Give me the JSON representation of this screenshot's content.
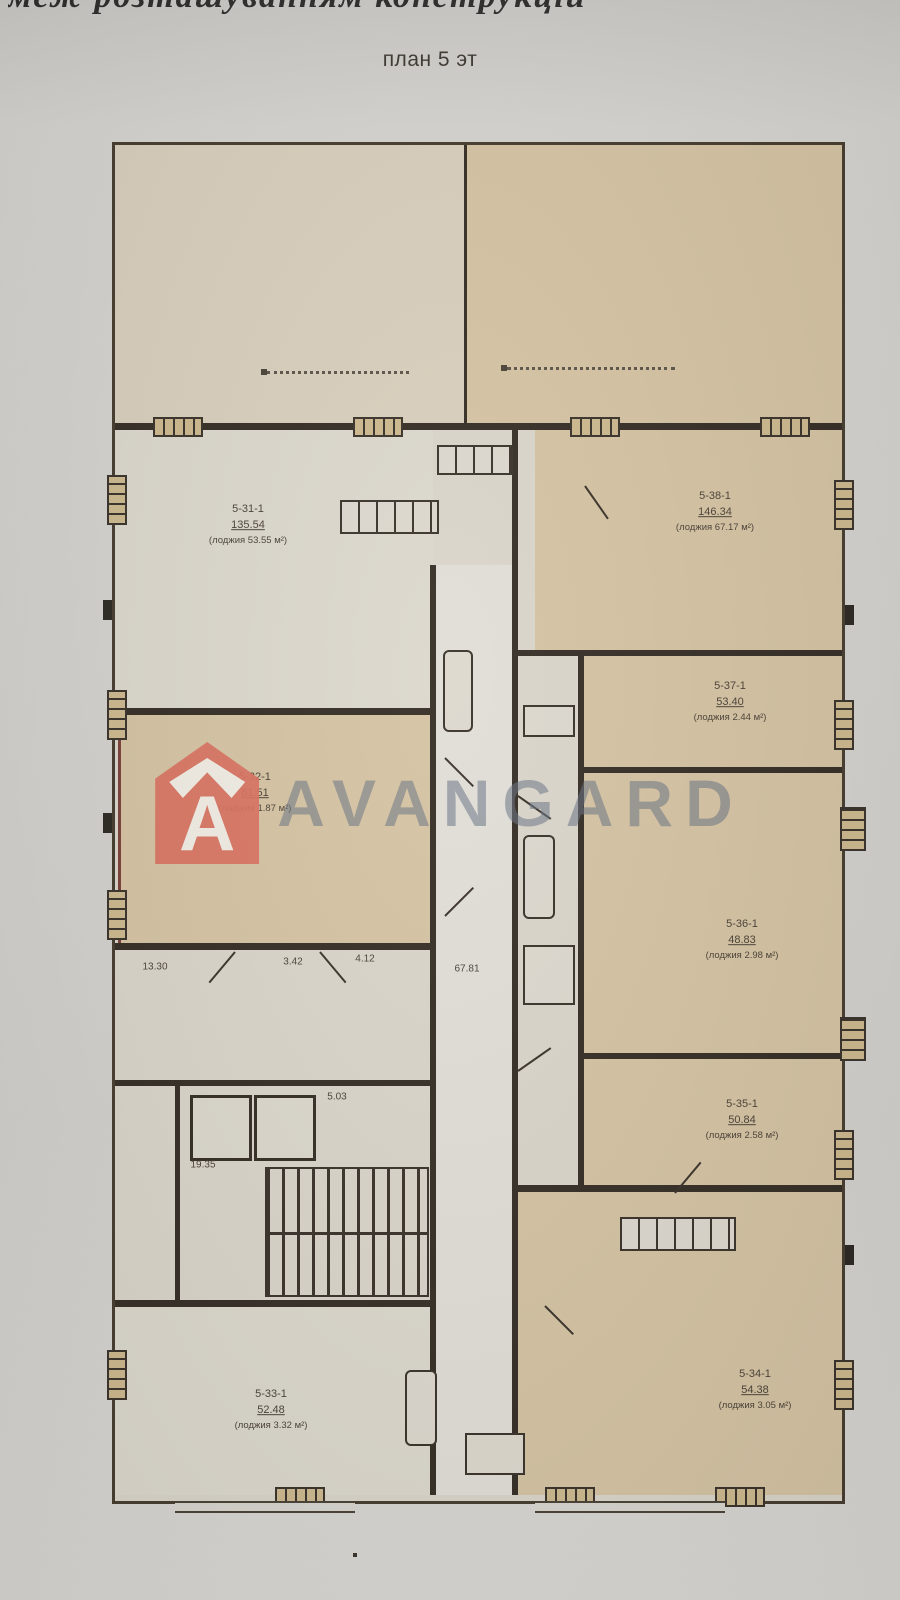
{
  "photo": {
    "clipped_top_text": "меж розташуванням конструкцій",
    "title": "план 5 эт"
  },
  "watermark": {
    "brand": "AVANGARD",
    "logo_letter": "A",
    "logo_color": "#da7160",
    "text_color": "#677383"
  },
  "plan": {
    "rooms": [
      {
        "id": "5-31-1",
        "area": "135.54",
        "note": "(лоджия 53.55 м²)"
      },
      {
        "id": "5-32-1",
        "area": "61.51",
        "note": "(лоджия 1.87 м²)"
      },
      {
        "id": "5-38-1",
        "area": "146.34",
        "note": "(лоджия 67.17 м²)"
      },
      {
        "id": "5-37-1",
        "area": "53.40",
        "note": "(лоджия 2.44 м²)"
      },
      {
        "id": "5-36-1",
        "area": "48.83",
        "note": "(лоджия 2.98 м²)"
      },
      {
        "id": "5-35-1",
        "area": "50.84",
        "note": "(лоджия 2.58 м²)"
      },
      {
        "id": "5-34-1",
        "area": "54.38",
        "note": "(лоджия 3.05 м²)"
      },
      {
        "id": "5-33-1",
        "area": "52.48",
        "note": "(лоджия 3.32 м²)"
      }
    ],
    "corridor_area": "67.81",
    "stair_area": "19.35",
    "lobby_area": "5.03",
    "hall_areas": [
      "13.30",
      "3.42",
      "4.12"
    ],
    "colors": {
      "wall": "#352e26",
      "room_tan": "#d5c3a3",
      "room_light": "#dcd8cd",
      "red_outline": "#7c4138",
      "paper": "#d3d1cd"
    }
  }
}
